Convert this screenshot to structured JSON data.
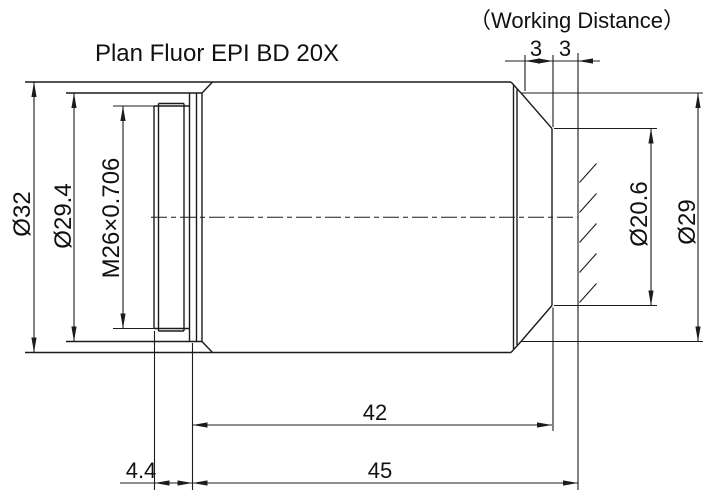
{
  "title": "Plan Fluor EPI  BD 20X",
  "working_distance": {
    "label": "（Working Distance）",
    "segment_left": "3",
    "segment_right": "3"
  },
  "dimensions": {
    "body_diameter": "Ø32",
    "mount_flange_diameter": "Ø29.4",
    "thread_spec": "M26×0.706",
    "front_aperture_diameter": "Ø20.6",
    "nose_diameter": "Ø29",
    "thread_length": "4.4",
    "shoulder_to_front_length": "42",
    "parfocal_length": "45"
  },
  "colors": {
    "line": "#1c1c1c",
    "text": "#111111",
    "background": "#ffffff"
  }
}
